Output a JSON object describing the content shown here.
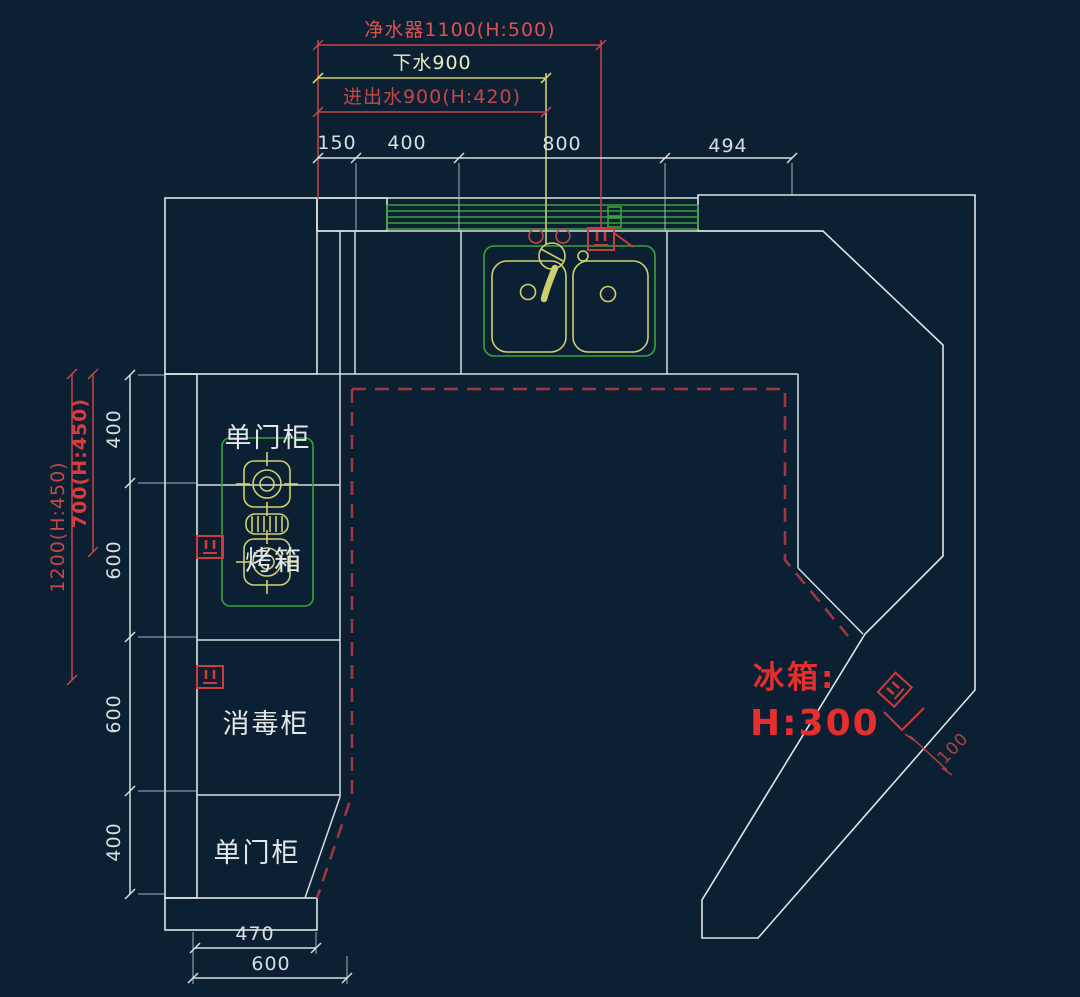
{
  "colors": {
    "background": "#0b2133",
    "line_white": "#d8dee2",
    "green": "#3aa23a",
    "yellow": "#cfcf6e",
    "dim_red": "#c64747",
    "bright_red": "#e62e2e",
    "dash_red": "#a03543"
  },
  "top_dims": {
    "purifier": "净水器1100(H:500)",
    "drain": "下水900",
    "inlet_outlet": "进出水900(H:420)",
    "segments": [
      "150",
      "400",
      "800",
      "494"
    ]
  },
  "left_dims": {
    "red": [
      "1200(H:450)",
      "700(H:450)"
    ],
    "white": [
      "400",
      "600",
      "600",
      "400"
    ]
  },
  "bottom_dims": [
    "470",
    "600"
  ],
  "right_dims": {
    "wall_gap": "100"
  },
  "cabinet_labels": {
    "top": "单门柜",
    "oven": "烤箱",
    "sterilizer": "消毒柜",
    "bottom": "单门柜"
  },
  "fridge_label": {
    "line1": "冰箱:",
    "line2": "H:300"
  }
}
